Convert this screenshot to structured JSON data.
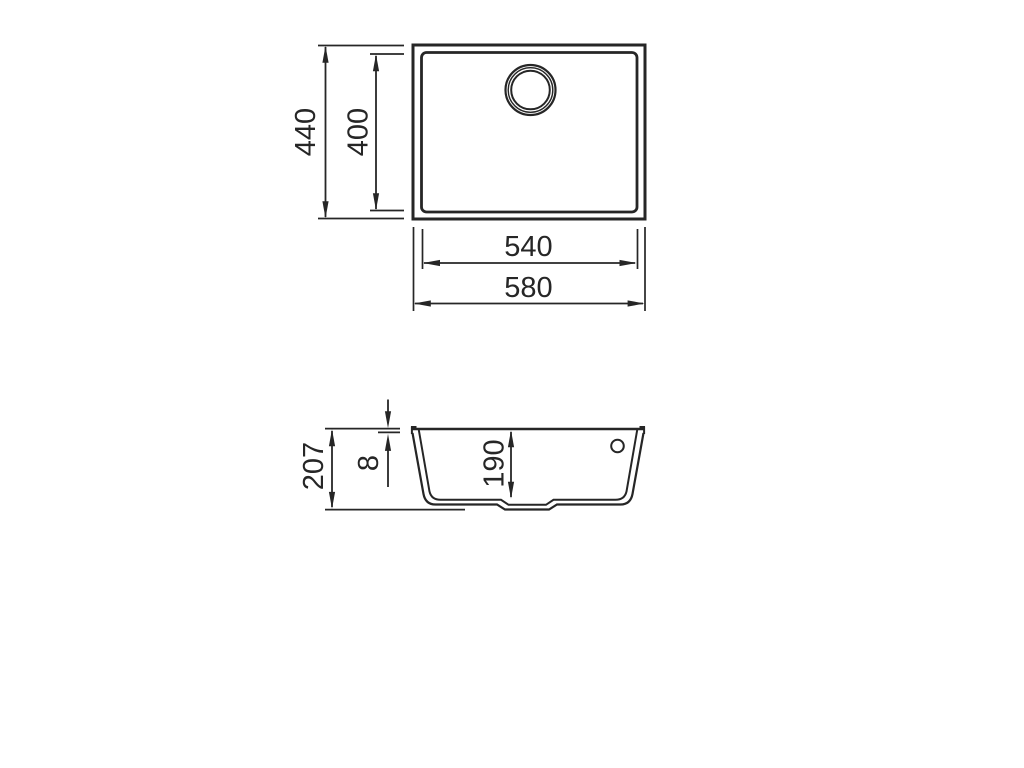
{
  "drawing": {
    "colors": {
      "line": "#262626",
      "background": "#ffffff"
    },
    "views": {
      "top": {
        "dims": {
          "overall_depth": "440",
          "bowl_depth": "400",
          "bowl_width": "540",
          "overall_width": "580"
        }
      },
      "section": {
        "dims": {
          "overall_height": "207",
          "rim_thickness": "8",
          "bowl_inner_depth": "190"
        }
      }
    }
  }
}
